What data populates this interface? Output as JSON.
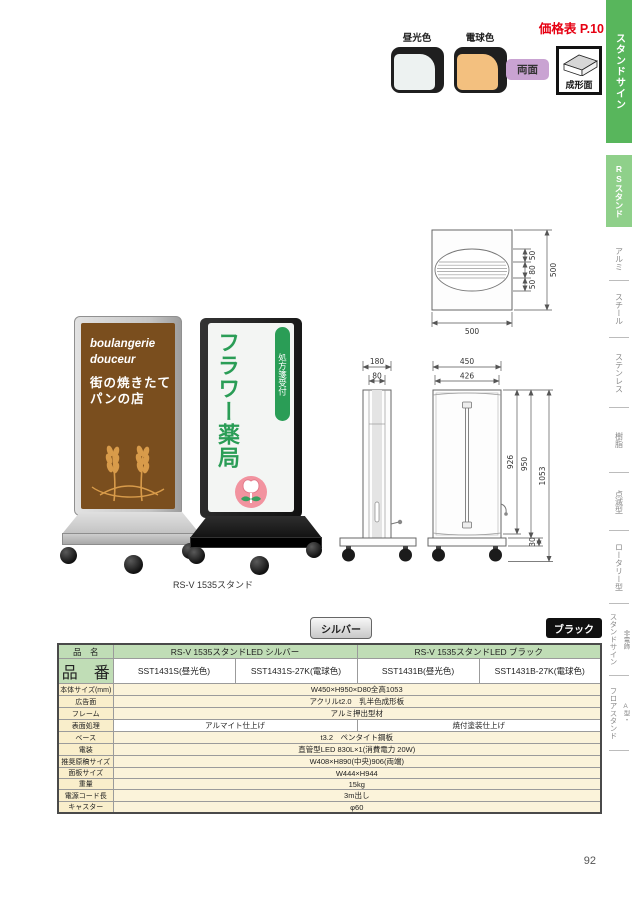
{
  "header": {
    "price_link": "価格表 P.10",
    "swatches": [
      {
        "label": "昼光色",
        "color": "#edf2f1"
      },
      {
        "label": "電球色",
        "color": "#f3c07f"
      }
    ],
    "double_side_badge": "両面",
    "molded_badge": "成形面"
  },
  "sidebar": {
    "items": [
      {
        "label": "スタンドサイン"
      },
      {
        "label": "RSスタンド"
      },
      {
        "label": "アルミ"
      },
      {
        "label": "スチール"
      },
      {
        "label": "ステンレス"
      },
      {
        "label": "樹脂"
      },
      {
        "label": "点滅型"
      },
      {
        "label": "ロータリー型"
      },
      {
        "label": "スタンドサイン",
        "prefix": "非電飾"
      },
      {
        "label": "フロアスタンド",
        "prefix": "A型・"
      }
    ]
  },
  "products": {
    "caption": "RS-V 1535スタンド",
    "bakery_sign": {
      "line1": "boulangerie",
      "line2": "douceur",
      "line3": "街の焼きたて",
      "line4": "パンの店"
    },
    "pharmacy_sign": {
      "main": "フラワー薬局",
      "ribbon": "処方箋受付"
    }
  },
  "drawings": {
    "top_view": {
      "width_label": "500",
      "height_label": "500",
      "detail_labels": [
        "50",
        "80",
        "50"
      ]
    },
    "side_view": {
      "outer_width": "180",
      "inner_width": "80"
    },
    "front_view": {
      "outer_width": "450",
      "inner_width": "426",
      "panel_height": "926",
      "body_height": "950",
      "total_height": "1053",
      "base_height": "30"
    }
  },
  "badges": {
    "silver": "シルバー",
    "black": "ブラック"
  },
  "spec_table": {
    "name_row": {
      "label": "品　名",
      "silver": "RS-V 1535スタンドLED シルバー",
      "black": "RS-V 1535スタンドLED ブラック"
    },
    "code_row": {
      "label": "品　番",
      "values": [
        "SST1431S(昼光色)",
        "SST1431S-27K(電球色)",
        "SST1431B(昼光色)",
        "SST1431B-27K(電球色)"
      ]
    },
    "rows": [
      {
        "label": "本体サイズ(mm)",
        "value": "W450×H950×D80全高1053"
      },
      {
        "label": "広告面",
        "value": "アクリルt2.0　乳半色成形板"
      },
      {
        "label": "フレーム",
        "value": "アルミ押出型材"
      },
      {
        "label": "表面処理",
        "values": [
          "アルマイト仕上げ",
          "焼付塗装仕上げ"
        ]
      },
      {
        "label": "ベース",
        "value": "t3.2　ペンタイト鋼板"
      },
      {
        "label": "電装",
        "value": "直管型LED 830L×1(消費電力 20W)"
      },
      {
        "label": "推奨原稿サイズ",
        "value": "W408×H890(中央)906(両端)"
      },
      {
        "label": "面板サイズ",
        "value": "W444×H944"
      },
      {
        "label": "重量",
        "value": "15kg"
      },
      {
        "label": "電源コード長",
        "value": "3m出し"
      },
      {
        "label": "キャスター",
        "value": "φ60"
      }
    ]
  },
  "page_number": "92",
  "colors": {
    "accent_green": "#58b65c",
    "light_green": "#8fd08a",
    "table_header_green": "#c0ddb6",
    "table_cream": "#fbf3da",
    "price_red": "#e60012",
    "badge_purple": "#c9a3d2",
    "sign_brown": "#7a4e1e",
    "sign_green": "#2a9d56",
    "logo_pink": "#f2939f"
  }
}
